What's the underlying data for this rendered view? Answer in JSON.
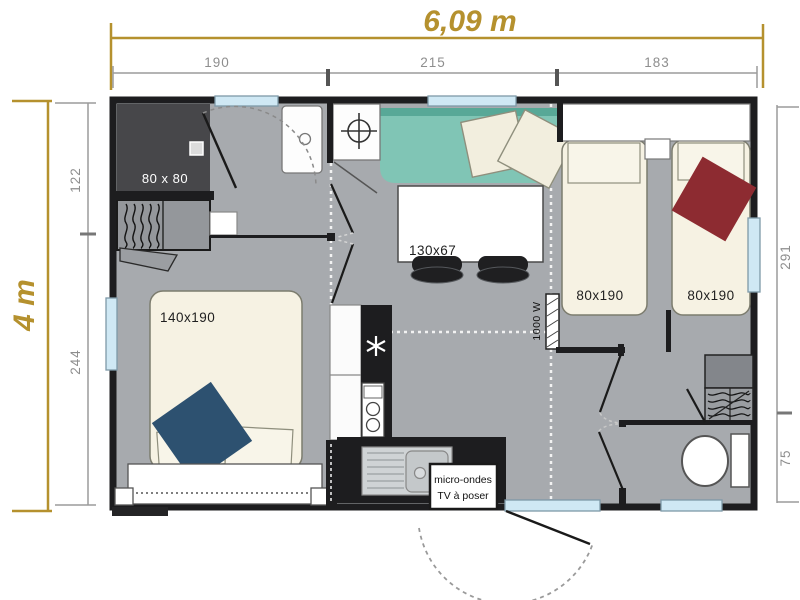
{
  "plan": {
    "title_width": "6,09 m",
    "title_height": "4 m",
    "dims_top": {
      "seg1": "190",
      "seg2": "215",
      "seg3": "183"
    },
    "dims_left": {
      "seg1": "122",
      "seg2": "244"
    },
    "dims_right": {
      "seg1": "291",
      "seg2": "75"
    },
    "labels": {
      "shower": "80 x 80",
      "double_bed": "140x190",
      "table": "130x67",
      "single_bed_left": "80x190",
      "single_bed_right": "80x190",
      "heater": "1000 W",
      "note_line1": "micro-ondes",
      "note_line2": "TV à poser"
    },
    "colors": {
      "gold": "#b5912e",
      "floor": "#a7aaae",
      "wall": "#1d1d1f",
      "sofa": "#80c5b5",
      "sofa_dark": "#58a897",
      "bed_cream": "#f6f2e3",
      "blanket_red": "#8d2b31",
      "blanket_blue": "#2d5170",
      "window_blue": "#cfe8f4",
      "shower_dark": "#47474a",
      "dim_gray": "#9b9b9b"
    }
  }
}
